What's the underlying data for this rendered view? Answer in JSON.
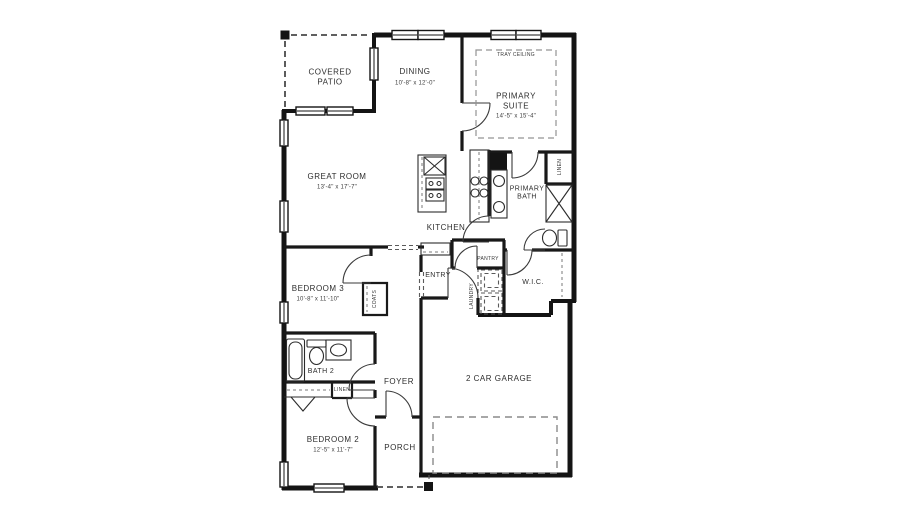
{
  "colors": {
    "wall": "#141414",
    "label": "#2e2e2e",
    "dashed_outline": "#8a8a8a"
  },
  "plan": {
    "rooms": {
      "covered_patio": {
        "name": "COVERED PATIO"
      },
      "dining": {
        "name": "DINING",
        "dims": "10'-8\" x 12'-0\""
      },
      "primary_suite": {
        "name": "PRIMARY SUITE",
        "dims": "14'-5\" x 15'-4\"",
        "note": "TRAY CEILING"
      },
      "great_room": {
        "name": "GREAT ROOM",
        "dims": "13'-4\" x 17'-7\""
      },
      "kitchen": {
        "name": "KITCHEN"
      },
      "primary_bath": {
        "name": "PRIMARY BATH"
      },
      "linen_primary": {
        "name": "LINEN"
      },
      "pantry": {
        "name": "PANTRY"
      },
      "entry": {
        "name": "ENTRY"
      },
      "laundry": {
        "name": "LAUNDRY"
      },
      "wic": {
        "name": "W.I.C."
      },
      "bedroom3": {
        "name": "BEDROOM 3",
        "dims": "10'-8\" x 11'-10\""
      },
      "coats": {
        "name": "COATS"
      },
      "bath2": {
        "name": "BATH 2"
      },
      "linen2": {
        "name": "LINEN"
      },
      "bedroom2": {
        "name": "BEDROOM 2",
        "dims": "12'-5\" x 11'-7\""
      },
      "foyer": {
        "name": "FOYER"
      },
      "porch": {
        "name": "PORCH"
      },
      "garage": {
        "name": "2 CAR GARAGE"
      }
    }
  }
}
